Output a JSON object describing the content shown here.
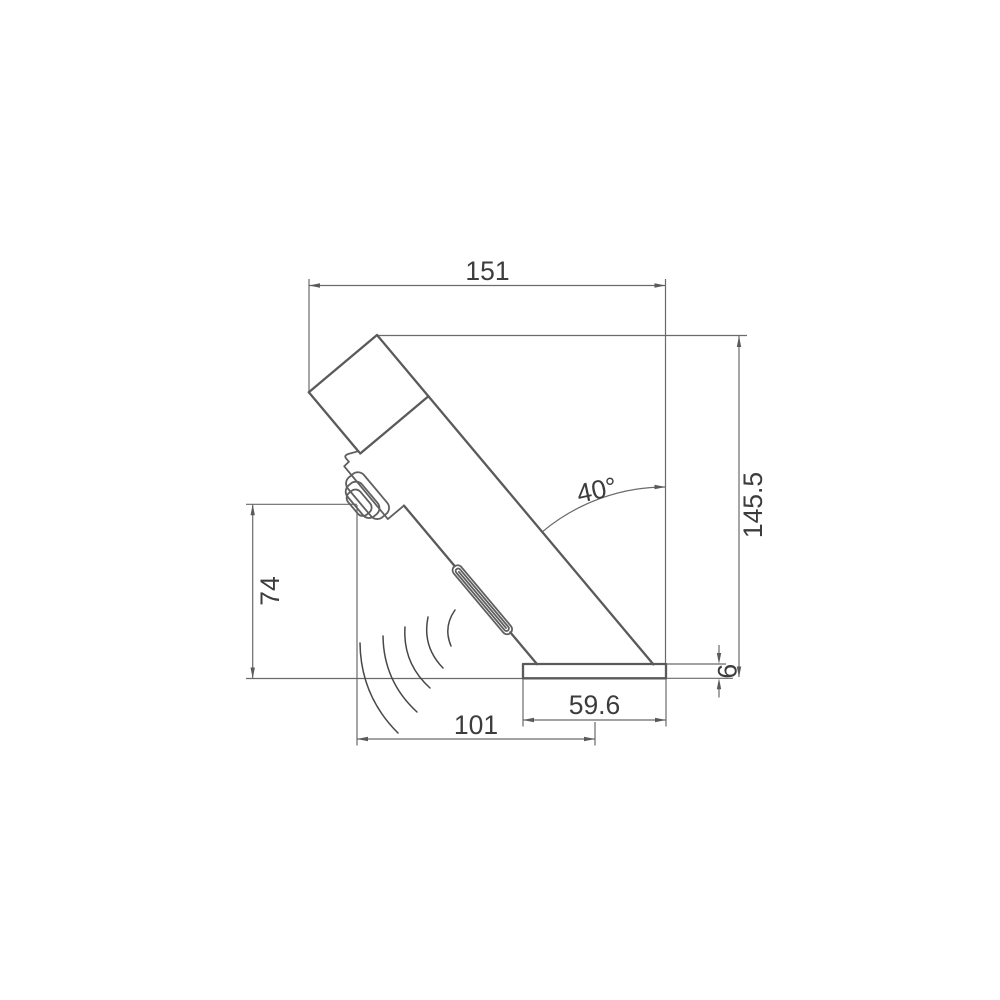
{
  "drawing": {
    "title": "sensor-faucet-side-view-dimension-drawing",
    "dims": {
      "top_width": "151",
      "overall_height": "145.5",
      "outlet_height": "74",
      "sensor_reach": "101",
      "base_width": "59.6",
      "base_thickness": "6",
      "spout_angle": "40°"
    },
    "colors": {
      "background": "#ffffff",
      "object_line": "#5a5a5a",
      "dimension_line": "#6a6a6a",
      "text": "#3c3c3c"
    }
  }
}
